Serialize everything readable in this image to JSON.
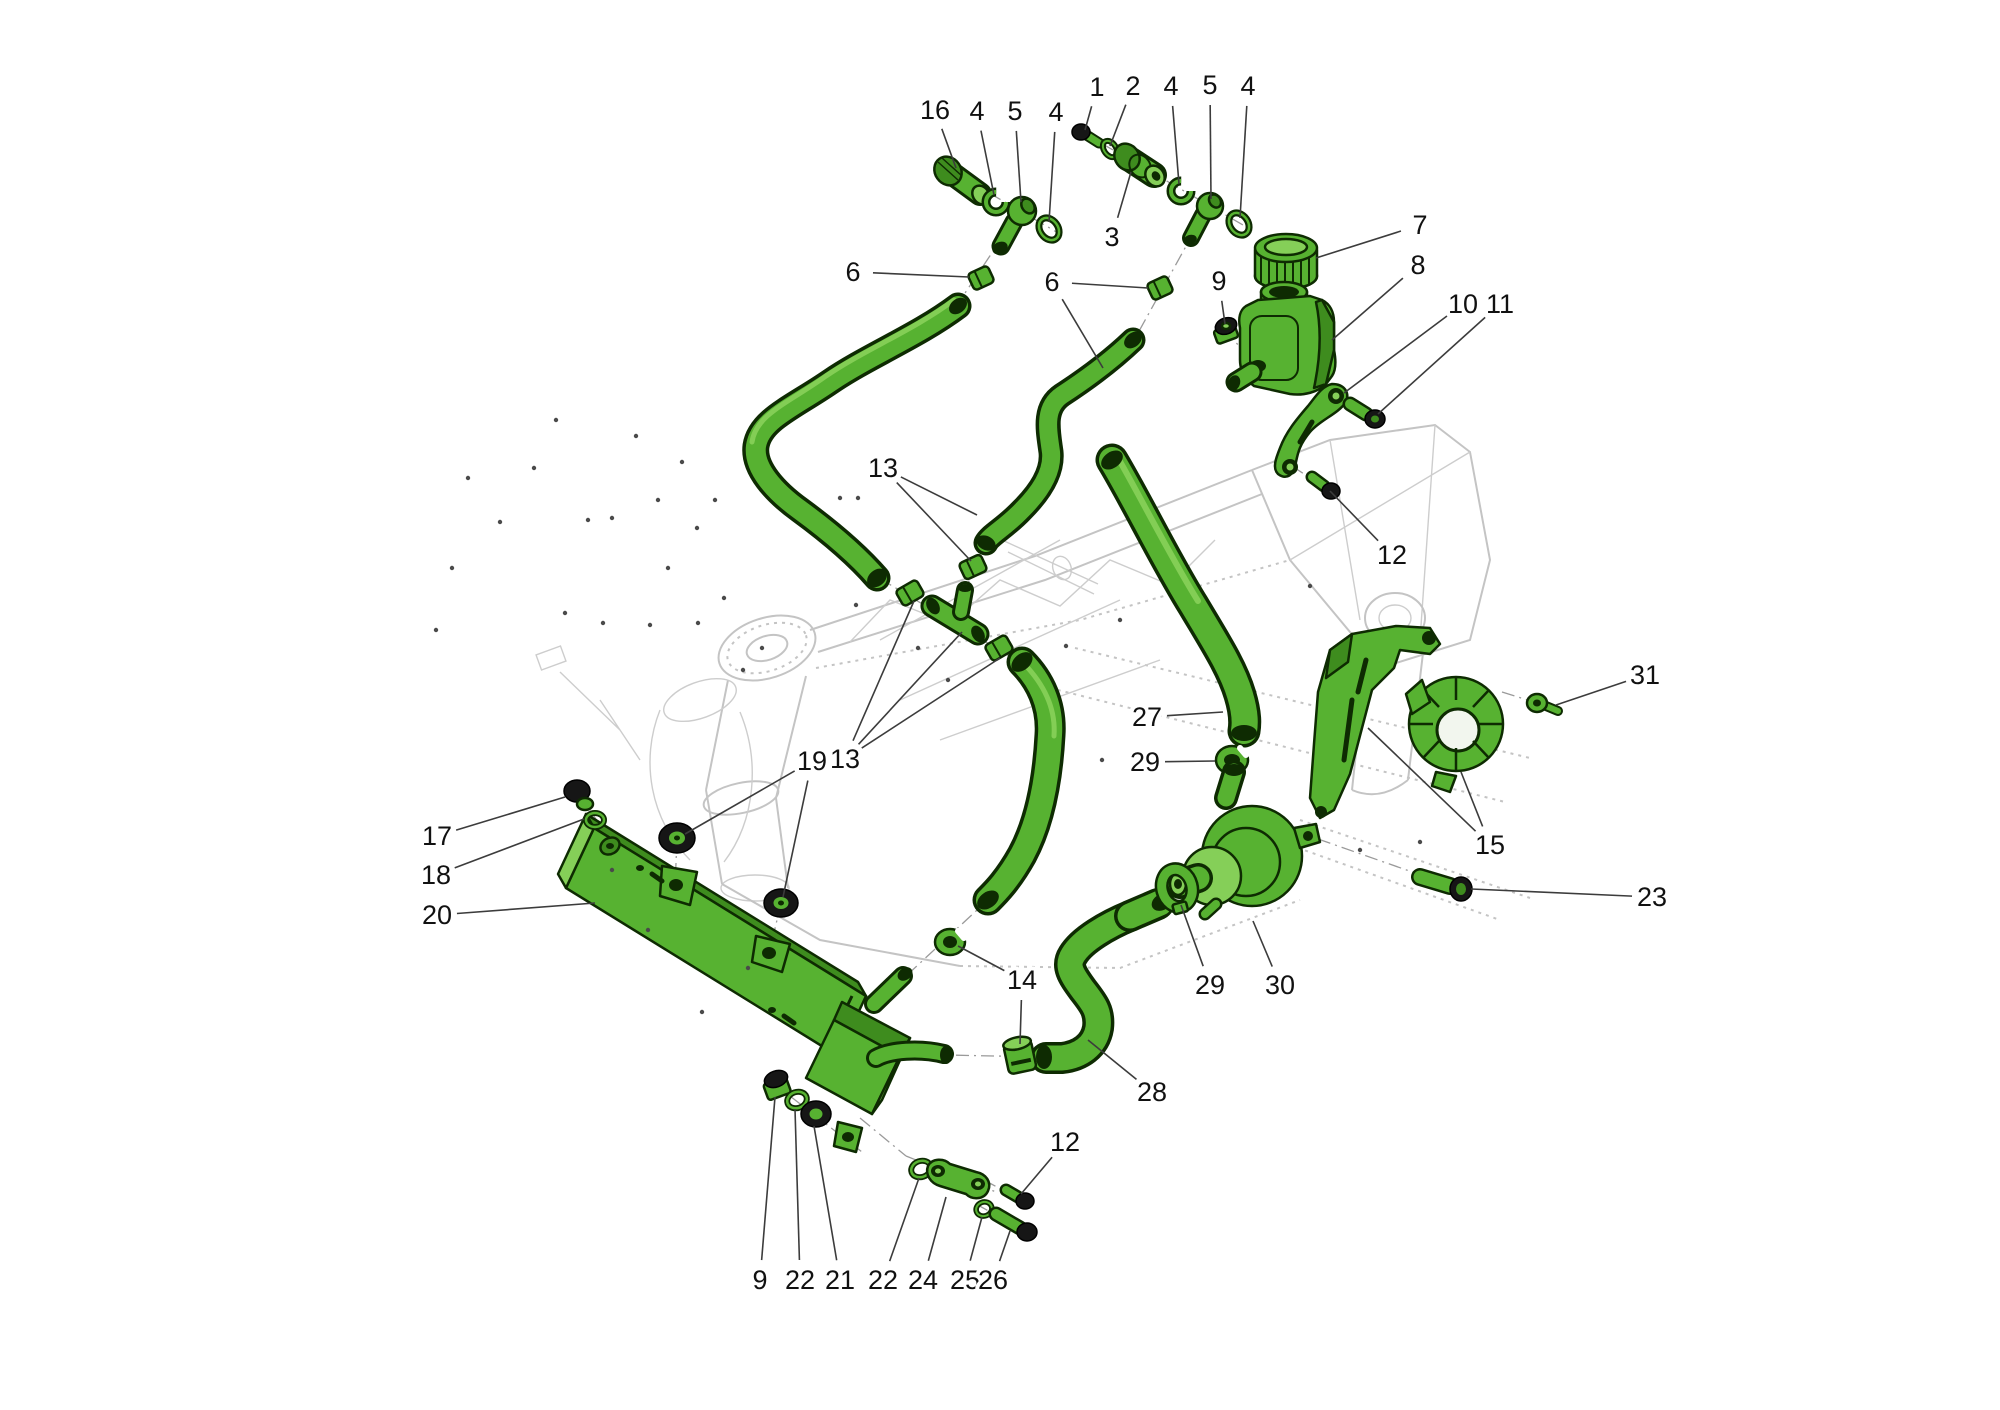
{
  "colors": {
    "part_green": "#57b231",
    "part_green_dark": "#3e8c1e",
    "part_green_light": "#85cf58",
    "part_outline": "#0e2b02",
    "hardware_black": "#161616",
    "frame_gray": "#c4c4c4",
    "leader_gray": "#3c3c3c",
    "label_black": "#111111",
    "background": "#ffffff"
  },
  "callouts": [
    {
      "label": "1",
      "x": 1097,
      "y": 87,
      "targets": [
        [
          1085,
          130
        ]
      ]
    },
    {
      "label": "2",
      "x": 1133,
      "y": 86,
      "targets": [
        [
          1110,
          146
        ]
      ]
    },
    {
      "label": "4",
      "x": 1171,
      "y": 86,
      "targets": [
        [
          1179,
          184
        ]
      ]
    },
    {
      "label": "5",
      "x": 1210,
      "y": 85,
      "targets": [
        [
          1211,
          199
        ]
      ]
    },
    {
      "label": "4",
      "x": 1248,
      "y": 86,
      "targets": [
        [
          1240,
          218
        ]
      ]
    },
    {
      "label": "16",
      "x": 935,
      "y": 110,
      "targets": [
        [
          956,
          168
        ]
      ]
    },
    {
      "label": "4",
      "x": 977,
      "y": 111,
      "targets": [
        [
          994,
          195
        ]
      ]
    },
    {
      "label": "5",
      "x": 1015,
      "y": 111,
      "targets": [
        [
          1021,
          202
        ]
      ]
    },
    {
      "label": "4",
      "x": 1056,
      "y": 112,
      "targets": [
        [
          1049,
          222
        ]
      ]
    },
    {
      "label": "3",
      "x": 1112,
      "y": 237,
      "targets": [
        [
          1131,
          172
        ]
      ]
    },
    {
      "label": "6",
      "x": 853,
      "y": 272,
      "targets": [
        [
          969,
          277
        ]
      ]
    },
    {
      "label": "6",
      "x": 1052,
      "y": 282,
      "targets": [
        [
          1148,
          288
        ],
        [
          1103,
          368
        ]
      ]
    },
    {
      "label": "7",
      "x": 1420,
      "y": 225,
      "targets": [
        [
          1316,
          258
        ]
      ]
    },
    {
      "label": "8",
      "x": 1418,
      "y": 265,
      "targets": [
        [
          1332,
          340
        ]
      ]
    },
    {
      "label": "9",
      "x": 1219,
      "y": 281,
      "targets": [
        [
          1225,
          324
        ]
      ]
    },
    {
      "label": "10",
      "x": 1463,
      "y": 304,
      "targets": [
        [
          1344,
          393
        ]
      ]
    },
    {
      "label": "11",
      "x": 1500,
      "y": 304,
      "targets": [
        [
          1378,
          414
        ]
      ]
    },
    {
      "label": "12",
      "x": 1392,
      "y": 555,
      "targets": [
        [
          1330,
          491
        ]
      ]
    },
    {
      "label": "13",
      "x": 883,
      "y": 468,
      "targets": [
        [
          977,
          515
        ],
        [
          971,
          561
        ]
      ]
    },
    {
      "label": "27",
      "x": 1147,
      "y": 717,
      "targets": [
        [
          1223,
          712
        ]
      ]
    },
    {
      "label": "29",
      "x": 1145,
      "y": 762,
      "targets": [
        [
          1215,
          761
        ]
      ]
    },
    {
      "label": "31",
      "x": 1645,
      "y": 675,
      "targets": [
        [
          1556,
          705
        ]
      ]
    },
    {
      "label": "15",
      "x": 1490,
      "y": 845,
      "targets": [
        [
          1368,
          728
        ],
        [
          1461,
          772
        ]
      ]
    },
    {
      "label": "23",
      "x": 1652,
      "y": 897,
      "targets": [
        [
          1471,
          889
        ]
      ]
    },
    {
      "label": "29",
      "x": 1210,
      "y": 985,
      "targets": [
        [
          1181,
          905
        ]
      ]
    },
    {
      "label": "30",
      "x": 1280,
      "y": 985,
      "targets": [
        [
          1253,
          921
        ]
      ]
    },
    {
      "label": "28",
      "x": 1152,
      "y": 1092,
      "targets": [
        [
          1088,
          1040
        ]
      ]
    },
    {
      "label": "14",
      "x": 1022,
      "y": 980,
      "targets": [
        [
          958,
          946
        ],
        [
          1020,
          1044
        ]
      ]
    },
    {
      "label": "19",
      "x": 812,
      "y": 761,
      "targets": [
        [
          685,
          834
        ],
        [
          783,
          897
        ]
      ]
    },
    {
      "label": "13",
      "x": 845,
      "y": 759,
      "targets": [
        [
          914,
          601
        ],
        [
          962,
          632
        ],
        [
          1000,
          658
        ]
      ]
    },
    {
      "label": "17",
      "x": 437,
      "y": 836,
      "targets": [
        [
          565,
          797
        ]
      ]
    },
    {
      "label": "18",
      "x": 436,
      "y": 875,
      "targets": [
        [
          584,
          819
        ]
      ]
    },
    {
      "label": "20",
      "x": 437,
      "y": 915,
      "targets": [
        [
          595,
          903
        ]
      ]
    },
    {
      "label": "9",
      "x": 760,
      "y": 1280,
      "targets": [
        [
          775,
          1097
        ]
      ]
    },
    {
      "label": "22",
      "x": 800,
      "y": 1280,
      "targets": [
        [
          795,
          1109
        ]
      ]
    },
    {
      "label": "21",
      "x": 840,
      "y": 1280,
      "targets": [
        [
          814,
          1126
        ]
      ]
    },
    {
      "label": "22",
      "x": 883,
      "y": 1280,
      "targets": [
        [
          919,
          1178
        ]
      ]
    },
    {
      "label": "24",
      "x": 923,
      "y": 1280,
      "targets": [
        [
          946,
          1197
        ]
      ]
    },
    {
      "label": "25",
      "x": 965,
      "y": 1280,
      "targets": [
        [
          982,
          1217
        ]
      ]
    },
    {
      "label": "26",
      "x": 993,
      "y": 1280,
      "targets": [
        [
          1010,
          1231
        ]
      ]
    },
    {
      "label": "12",
      "x": 1065,
      "y": 1142,
      "targets": [
        [
          1021,
          1194
        ]
      ]
    }
  ],
  "centerlines": [
    [
      946,
      168,
      1060,
      234
    ],
    [
      1018,
      214,
      955,
      308
    ],
    [
      1080,
      131,
      1250,
      229
    ],
    [
      1206,
      210,
      1133,
      342
    ],
    [
      874,
      575,
      1026,
      666
    ],
    [
      988,
      542,
      957,
      606
    ],
    [
      990,
      898,
      905,
      977
    ],
    [
      1044,
      1057,
      946,
      1055
    ],
    [
      576,
      790,
      620,
      854
    ],
    [
      1224,
      330,
      1262,
      370
    ],
    [
      1336,
      394,
      1382,
      422
    ],
    [
      1292,
      466,
      1334,
      494
    ],
    [
      677,
      838,
      675,
      888
    ],
    [
      781,
      903,
      769,
      954
    ],
    [
      772,
      1082,
      862,
      1152
    ],
    [
      906,
      1156,
      996,
      1192
    ],
    [
      976,
      1204,
      1034,
      1236
    ],
    [
      984,
      1180,
      1030,
      1205
    ],
    [
      1318,
      839,
      1418,
      874
    ],
    [
      1502,
      692,
      1534,
      702
    ],
    [
      1243,
      722,
      1236,
      800
    ],
    [
      860,
      1118,
      906,
      1156
    ]
  ],
  "speckles": [
    [
      565,
      613
    ],
    [
      603,
      623
    ],
    [
      612,
      518
    ],
    [
      650,
      625
    ],
    [
      668,
      568
    ],
    [
      697,
      528
    ],
    [
      698,
      623
    ],
    [
      715,
      500
    ],
    [
      743,
      670
    ],
    [
      840,
      498
    ],
    [
      858,
      498
    ],
    [
      436,
      630
    ],
    [
      452,
      568
    ],
    [
      468,
      478
    ],
    [
      500,
      522
    ],
    [
      534,
      468
    ],
    [
      556,
      420
    ],
    [
      588,
      520
    ],
    [
      636,
      436
    ],
    [
      658,
      500
    ],
    [
      682,
      462
    ],
    [
      724,
      598
    ],
    [
      762,
      648
    ],
    [
      918,
      648
    ],
    [
      948,
      680
    ],
    [
      1066,
      646
    ],
    [
      1120,
      620
    ],
    [
      856,
      605
    ],
    [
      1310,
      586
    ],
    [
      1360,
      850
    ],
    [
      1420,
      842
    ],
    [
      702,
      1012
    ],
    [
      748,
      968
    ],
    [
      1102,
      760
    ],
    [
      612,
      870
    ],
    [
      648,
      930
    ]
  ]
}
